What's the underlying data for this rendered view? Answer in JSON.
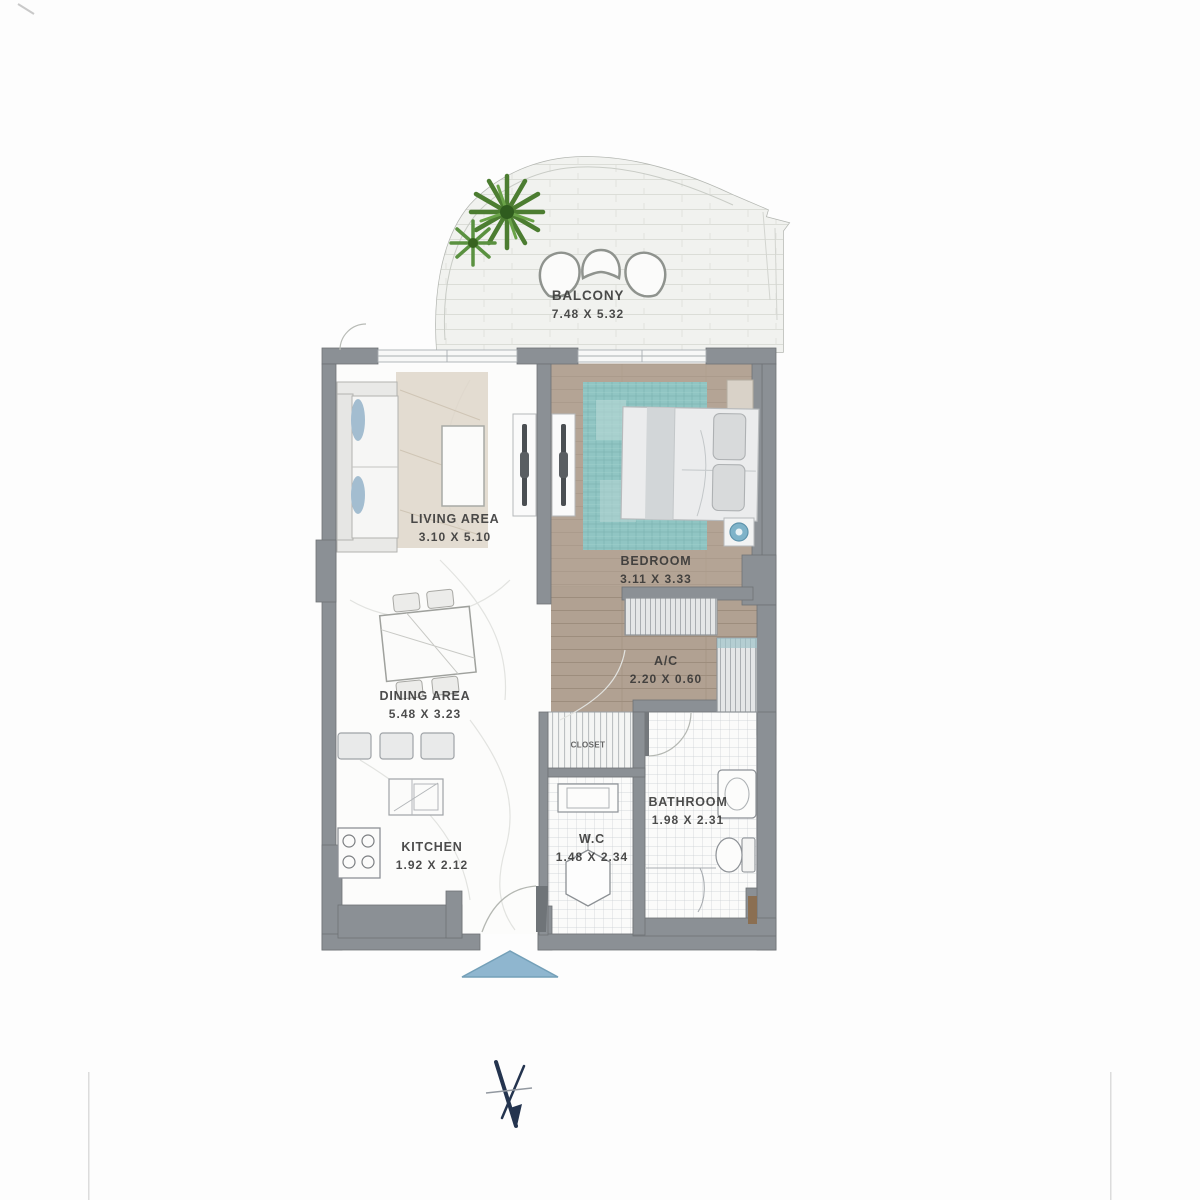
{
  "plan": {
    "title": "apartment-floor-plan",
    "rooms": [
      {
        "id": "balcony",
        "name": "BALCONY",
        "dims": "7.48 X 5.32"
      },
      {
        "id": "living",
        "name": "LIVING AREA",
        "dims": "3.10 X 5.10"
      },
      {
        "id": "dining",
        "name": "DINING AREA",
        "dims": "5.48 X 3.23"
      },
      {
        "id": "bedroom",
        "name": "BEDROOM",
        "dims": "3.11 X 3.33"
      },
      {
        "id": "ac",
        "name": "A/C",
        "dims": "2.20 X 0.60"
      },
      {
        "id": "bathroom",
        "name": "BATHROOM",
        "dims": "1.98 X 2.31"
      },
      {
        "id": "kitchen",
        "name": "KITCHEN",
        "dims": "1.92 X 2.12"
      },
      {
        "id": "wc",
        "name": "W.C",
        "dims": "1.48 X 2.34"
      },
      {
        "id": "closet",
        "name": "CLOSET",
        "dims": ""
      }
    ],
    "markers": {
      "entry_arrow": "entry-direction-marker",
      "north_symbol": "north-arrow-marker"
    },
    "colors": {
      "wall_gray": "#8b9095",
      "bedroom_wood": "#b6a698",
      "rug_teal": "#90c5c3",
      "entry_arrow_blue": "#8fb6cf",
      "north_navy": "#24344f",
      "plant_green": "#4c7d31",
      "label_ink": "#343434"
    }
  }
}
